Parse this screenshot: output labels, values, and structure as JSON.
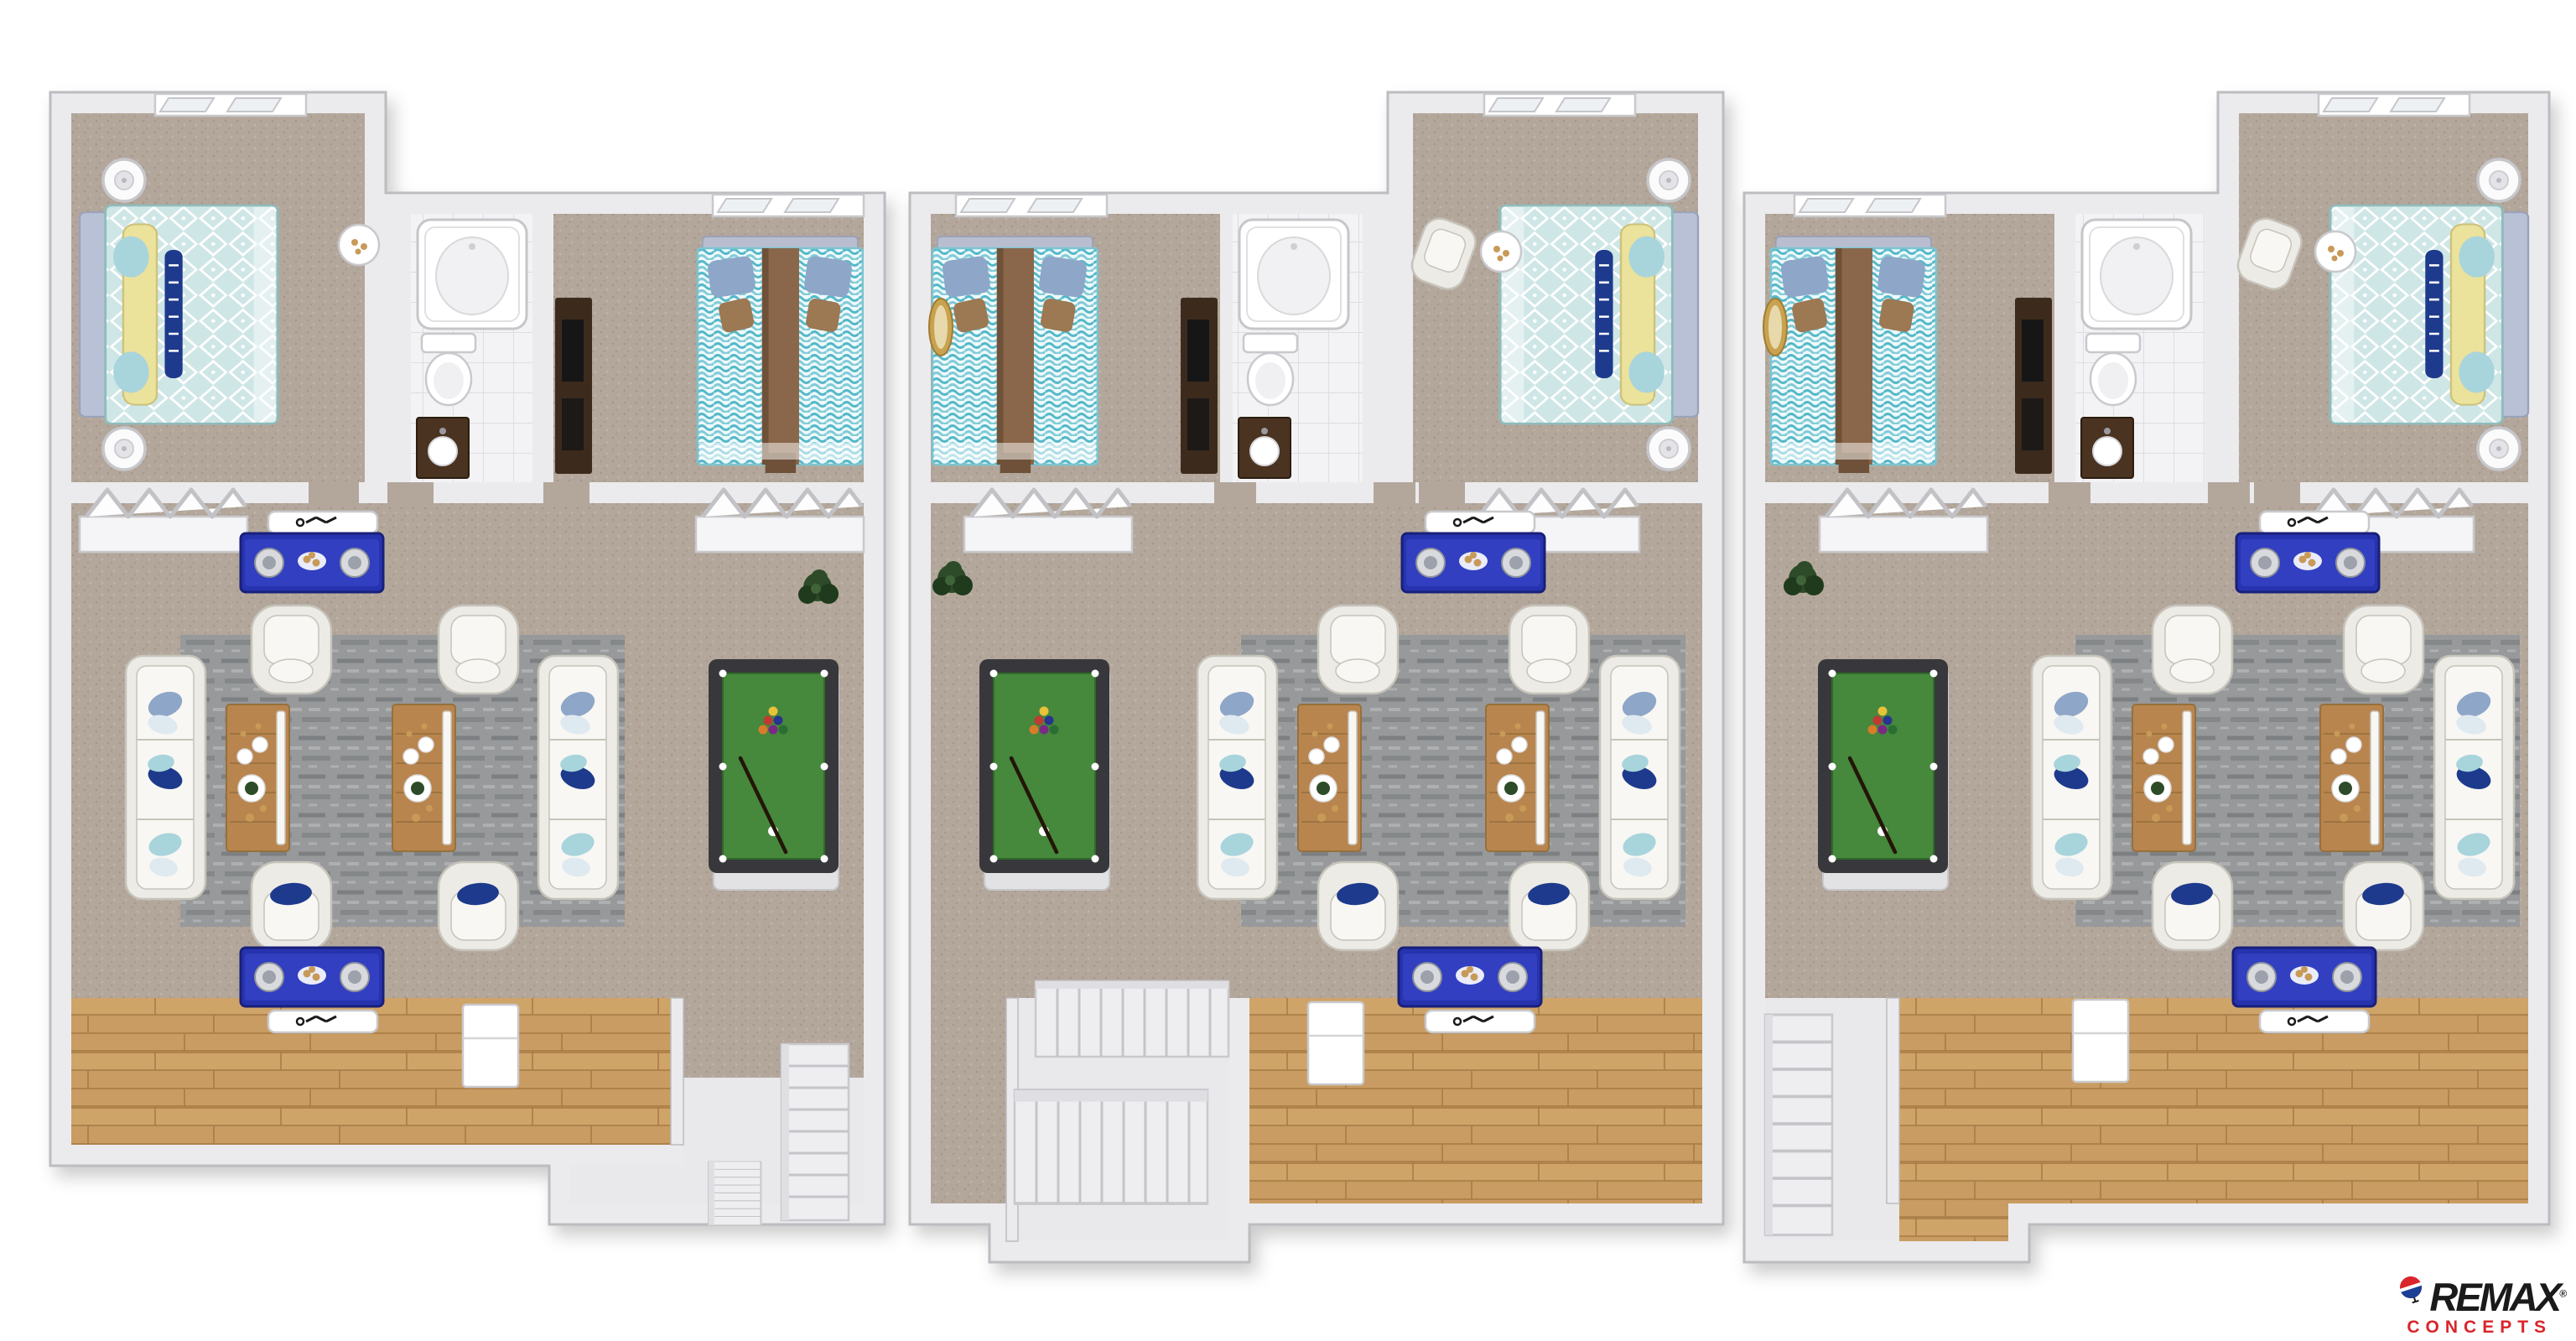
{
  "image_type": "3d-floor-plan-rendering",
  "logo": {
    "brand": "REMAX",
    "registered": "®",
    "subtitle": "CONCEPTS"
  },
  "palette": {
    "background": "#ffffff",
    "wall_fill": "#ebebee",
    "wall_edge": "#bcbcc1",
    "carpet": "#b3a79b",
    "carpet_dot": "#a4978a",
    "carpet_dot2": "#c1b5a9",
    "wood": "#c89c62",
    "wood_line": "#a97c45",
    "wood_light": "#d8ad72",
    "tile": "#f3f3f5",
    "tile_line": "#dddde2",
    "rug": "#97999b",
    "rug_dark": "#7d8082",
    "rug_light": "#adafb1",
    "sofa": "#edebe6",
    "sofa_edge": "#c6c3ba",
    "cushion": "#f8f7f3",
    "pillow_blue": "#8ea6c8",
    "pillow_navy": "#1e3a8c",
    "pillow_pale": "#dfe9f0",
    "pillow_teal": "#a8d4dc",
    "console_blue": "#2733ae",
    "console_light": "#3a49cf",
    "console_edge": "#18207a",
    "speaker": "#d8dade",
    "felt": "#46883c",
    "felt_edge": "#2f6b28",
    "rail": "#38383c",
    "pool_base": "#e2e2e5",
    "bed_teal": "#cfe6e6",
    "wave_teal": "#54b8c8",
    "wave_bg": "#eef9fb",
    "runner_brown": "#8a674a",
    "cushion_brown": "#9c7853",
    "headboard": "#b9c1d6",
    "yellow_pillow": "#ebe29b",
    "plant": "#2d4b28",
    "plant_dark": "#1f3a1c",
    "lamp": "#fbfbfc",
    "lamp_edge": "#c6c6cb",
    "vanity_brown": "#4b3322",
    "tv_dark": "#161616",
    "tv_wood": "#3c2b1d",
    "mirror_gold": "#c8a24f",
    "table_wood": "#b9854e",
    "logo_black": "#1a1a1a",
    "logo_red": "#d9252b",
    "balloon_red": "#d9252b",
    "balloon_blue": "#1b3f94"
  },
  "units": [
    {
      "id": "unit-1",
      "rooms": [
        "master-bedroom",
        "bathroom",
        "bedroom-2",
        "hall-closets",
        "living-room",
        "kitchen",
        "entry-stairs"
      ],
      "furnishings": [
        "master-bed",
        "table-lamps",
        "bathtub",
        "toilet",
        "vanity-sink",
        "wave-bed",
        "dresser-tv",
        "bifold-closets",
        "two-sofas",
        "four-armchairs",
        "two-coffee-tables",
        "area-rug",
        "media-consoles",
        "pool-table",
        "potted-plant",
        "refrigerator",
        "staircase"
      ]
    },
    {
      "id": "unit-2",
      "rooms": [
        "bedroom-2",
        "bathroom",
        "master-bedroom",
        "hall-closets",
        "living-room",
        "kitchen",
        "entry-stairs"
      ],
      "furnishings": [
        "wave-bed",
        "wall-mirror",
        "bathtub",
        "toilet",
        "vanity-sink",
        "master-bed",
        "accent-chair",
        "side-table",
        "table-lamps",
        "bifold-closets",
        "two-sofas",
        "four-armchairs",
        "two-coffee-tables",
        "area-rug",
        "media-consoles",
        "pool-table",
        "potted-plant",
        "refrigerator",
        "staircase"
      ]
    },
    {
      "id": "unit-3",
      "rooms": [
        "bedroom-2",
        "bathroom",
        "master-bedroom",
        "hall-closets",
        "living-room",
        "kitchen",
        "entry-stairs"
      ],
      "furnishings": [
        "wave-bed",
        "wall-mirror",
        "bathtub",
        "toilet",
        "vanity-sink",
        "master-bed",
        "accent-chair",
        "side-table",
        "table-lamps",
        "bifold-closets",
        "two-sofas",
        "four-armchairs",
        "two-coffee-tables",
        "area-rug",
        "media-consoles",
        "pool-table",
        "potted-plant",
        "refrigerator",
        "staircase"
      ]
    }
  ]
}
